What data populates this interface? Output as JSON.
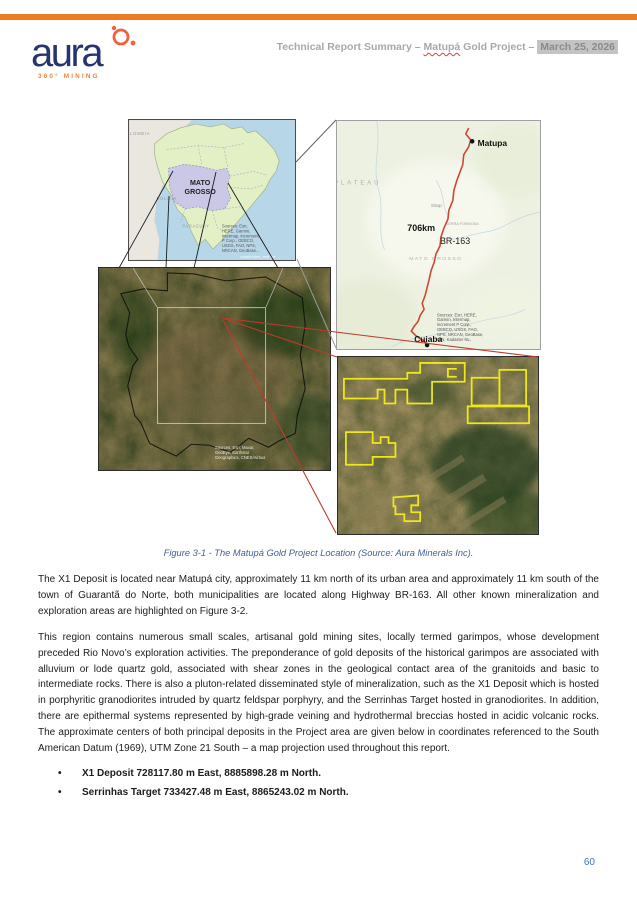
{
  "header": {
    "logo_word": "aura",
    "logo_tagline": "360° MINING",
    "title_prefix": "Technical Report Summary – ",
    "title_project_word": "Matupá",
    "title_middle": " Gold Project – ",
    "title_date": "March 25, 2026"
  },
  "figure": {
    "caption": "Figure 3-1 - The Matupá Gold Project Location (Source: Aura Minerals Inc).",
    "brazil_map": {
      "state_line1": "MATO",
      "state_line2": "GROSSO",
      "label_colombia": "LOMBIA",
      "label_bolivia": "BOLIVIA",
      "label_paraguay": "PARAGUAY",
      "attribution": "contributors, and the",
      "sources": [
        "Sources: Esri,",
        "HERE, Garmin,",
        "Intermap, increment",
        "P Corp., GEBCO,",
        "USGS, FAO, NPS,",
        "NRCAN, GeoBase..."
      ]
    },
    "road_map": {
      "city_north": "Matupa",
      "city_south": "Cuiaba",
      "distance_label": "706km",
      "highway_label": "BR-163",
      "label_plateau": "PLATEAU",
      "label_serra": "SERRA FORMOSA",
      "label_state": "MATO GROSSO",
      "label_town": "Sinop",
      "sources": [
        "Sources: Esri, HERE,",
        "Garmin, Intermap,",
        "increment P Corp.,",
        "GEBCO, USGS, FAO,",
        "NPS, NRCAN, GeoBase,",
        "IGN, Kadaster NL,"
      ]
    },
    "satellite_map": {
      "sources": [
        "Sources: Esri, Maxar,",
        "GeoEye, Earthstar",
        "Geographics, CNES/Airbus"
      ]
    }
  },
  "body": {
    "paragraph1": "The X1 Deposit is located near  Matupá city, approximately 11 km north of its urban area and approximately 11 km south of the town of Guarantã do Norte, both municipalities are located along Highway BR-163. All other known mineralization and exploration areas are highlighted on Figure 3-2.",
    "paragraph2": "This region contains numerous small scales, artisanal gold mining sites, locally termed garimpos, whose development preceded Rio Novo’s exploration activities. The preponderance of gold deposits of the historical garimpos are associated with alluvium or lode quartz gold, associated with shear zones in the geological contact area of the granitoids and basic to intermediate rocks. There is also a pluton-related disseminated style of mineralization, such as the X1 Deposit which is hosted in porphyritic granodiorites intruded by quartz feldspar porphyry, and the Serrinhas Target hosted in granodiorites. In addition, there are epithermal systems represented by high-grade veining and hydrothermal breccias hosted in acidic volcanic rocks. The approximate centers of both principal deposits in the Project area are given below in coordinates referenced to the South American Datum (1969), UTM Zone 21 South – a map projection used throughout this report.",
    "bullet_glyph": "•",
    "bullets": [
      "X1 Deposit 728117.80 m East, 8885898.28 m North.",
      "Serrinhas Target 733427.48 m East, 8865243.02 m North."
    ]
  },
  "footer": {
    "page_number": "60"
  },
  "colors": {
    "accent_orange": "#EB7C24",
    "logo_navy": "#27356E",
    "caption_blue": "#44608F",
    "page_number_blue": "#4472C4",
    "route_red": "#CF4631",
    "tenement_yellow": "#EFE71C",
    "state_fill_lavender": "#CBC8E7",
    "brazil_fill_green": "#E3EFC5",
    "ocean_blue": "#B7D7E9"
  }
}
